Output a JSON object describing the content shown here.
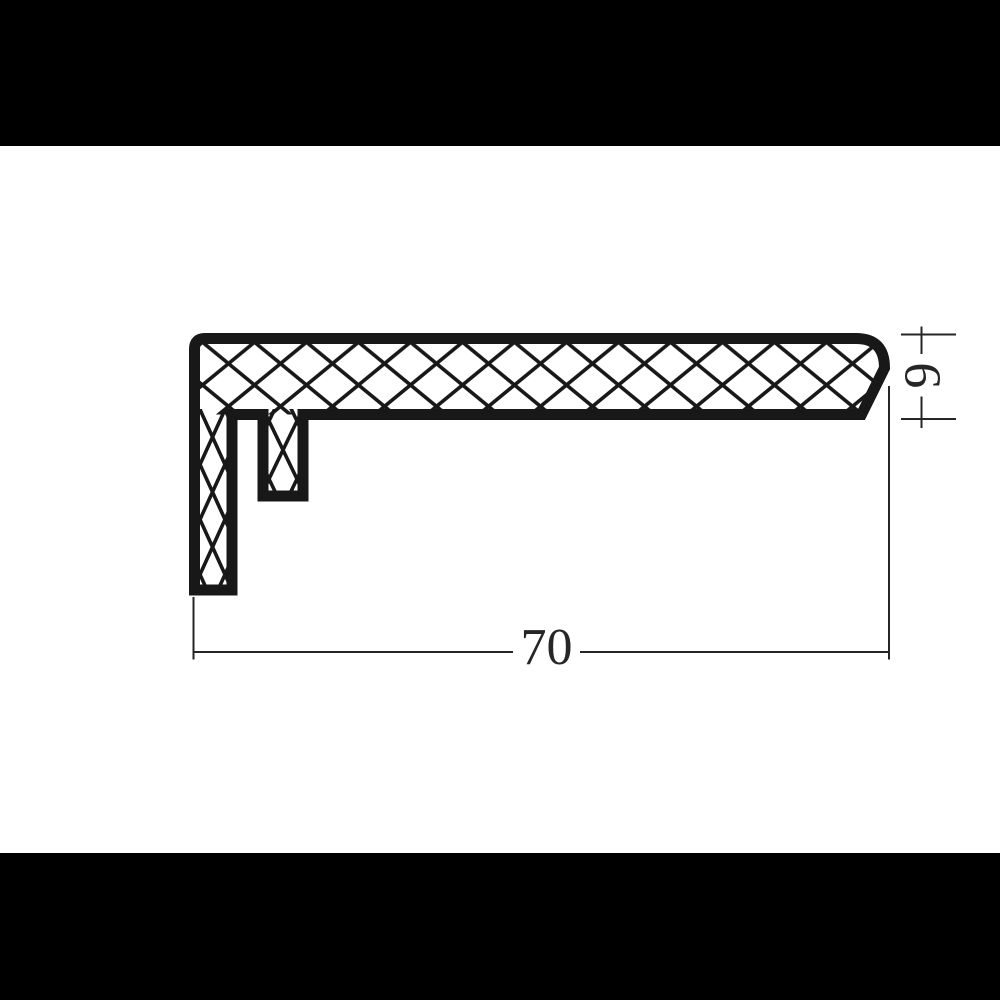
{
  "page": {
    "background_color": "#ffffff",
    "letterbox_color": "#000000"
  },
  "drawing": {
    "type": "profile-cross-section-technical-drawing",
    "ink_color": "#181818",
    "dimension_color": "#262626",
    "hatch_pattern": "diamond-crosshatch",
    "dimensions": [
      {
        "label": "70",
        "orientation": "horizontal",
        "measures": "overall-width"
      },
      {
        "label": "9",
        "orientation": "vertical",
        "measures": "flange-thickness"
      }
    ],
    "dim70_label": "70",
    "dim9_label": "9"
  }
}
